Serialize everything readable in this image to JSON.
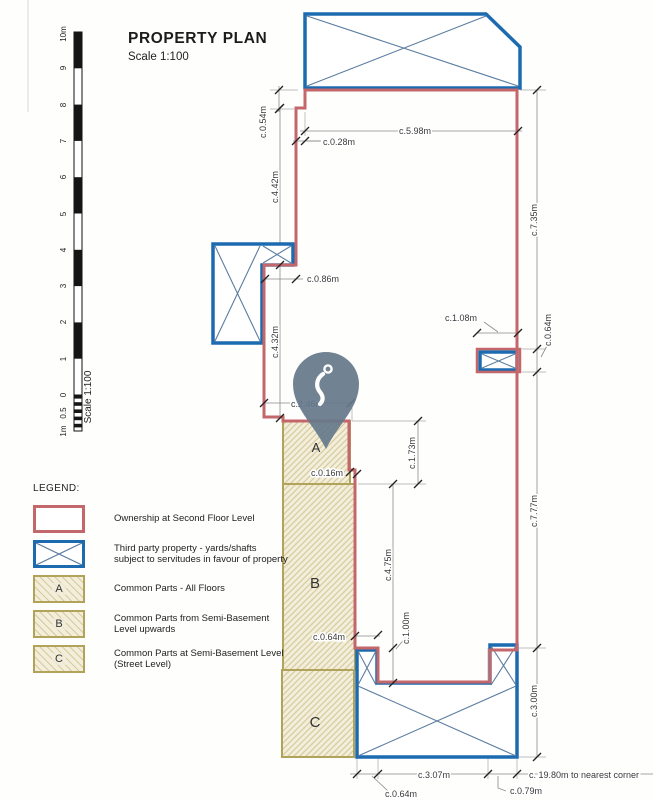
{
  "title": {
    "heading": "PROPERTY PLAN",
    "scale": "Scale 1:100"
  },
  "scale_bar": {
    "labels": [
      "10m",
      "9",
      "8",
      "7",
      "6",
      "5",
      "4",
      "3",
      "2",
      "1",
      "0",
      "0.5",
      "1m"
    ],
    "caption": "Scale 1:100"
  },
  "legend": {
    "heading": "LEGEND:",
    "items": [
      {
        "letter": "",
        "line1": "Ownership at Second Floor Level",
        "line2": ""
      },
      {
        "letter": "",
        "line1": "Third party property - yards/shafts",
        "line2": "subject to servitudes in favour of property"
      },
      {
        "letter": "A",
        "line1": "Common Parts - All Floors",
        "line2": ""
      },
      {
        "letter": "B",
        "line1": "Common Parts from Semi-Basement",
        "line2": "Level upwards"
      },
      {
        "letter": "C",
        "line1": "Common Parts at Semi-Basement Level",
        "line2": "(Street Level)"
      }
    ]
  },
  "zones": {
    "a": "A",
    "b": "B",
    "c": "C"
  },
  "dims": {
    "d_054": "c.0.54m",
    "d_028": "c.0.28m",
    "d_598": "c.5.98m",
    "d_442": "c.4.42m",
    "d_086": "c.0.86m",
    "d_432": "c.4.32m",
    "d_735": "c.7.35m",
    "d_108": "c.1.08m",
    "d_064_shaft": "c.0.64m",
    "d_246": "c.2.46m",
    "d_173": "c.1.73m",
    "d_016": "c.0.16m",
    "d_475": "c.4.75m",
    "d_777": "c.7.77m",
    "d_064_step": "c.0.64m",
    "d_100": "c.1.00m",
    "d_300": "c.3.00m",
    "d_307": "c.3.07m",
    "d_064_bottom": "c.0.64m",
    "d_079": "c.0.79m",
    "d_1980": "c. 19.80m to nearest corner"
  },
  "colors": {
    "ownership_red": "#c4676b",
    "third_party_blue": "#1c6bb0",
    "common_tan_border": "#b2a35b",
    "common_tan_fill": "#f3eedb",
    "pin_gray": "#66798b"
  }
}
